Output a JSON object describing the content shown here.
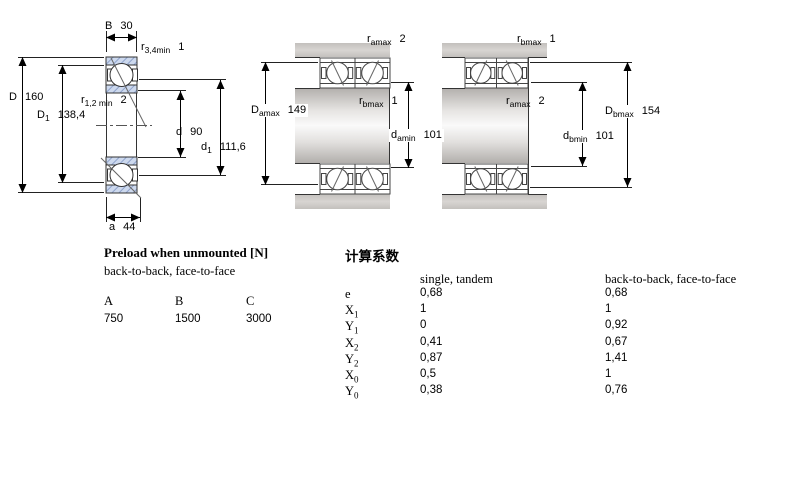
{
  "colors": {
    "ring_hatch_fill": "#cdd9ee",
    "ring_hatch_line": "#8fa3cc",
    "metal_gray": "#c9c6c3"
  },
  "drawing_left": {
    "labels": {
      "B": {
        "sym": "B",
        "val": "30"
      },
      "r34": {
        "sym": "r",
        "sub": "3,4min",
        "val": "1"
      },
      "D": {
        "sym": "D",
        "val": "160"
      },
      "D1": {
        "sym": "D",
        "sub": "1",
        "val": "138,4"
      },
      "r12": {
        "sym": "r",
        "sub": "1,2 min",
        "val": "2"
      },
      "d": {
        "sym": "d",
        "val": "90"
      },
      "d1": {
        "sym": "d",
        "sub": "1",
        "val": "111,6"
      },
      "a": {
        "sym": "a",
        "val": "44"
      }
    }
  },
  "drawing_middle": {
    "labels": {
      "ramax_top": {
        "sym": "r",
        "sub": "amax",
        "val": "2"
      },
      "Damax": {
        "sym": "D",
        "sub": "amax",
        "val": "149"
      },
      "rbmax": {
        "sym": "r",
        "sub": "bmax",
        "val": "1"
      },
      "damin": {
        "sym": "d",
        "sub": "amin",
        "val": "101"
      }
    }
  },
  "drawing_right": {
    "labels": {
      "rbmax_top": {
        "sym": "r",
        "sub": "bmax",
        "val": "1"
      },
      "ramax": {
        "sym": "r",
        "sub": "amax",
        "val": "2"
      },
      "Dbmax": {
        "sym": "D",
        "sub": "bmax",
        "val": "154"
      },
      "dbmin": {
        "sym": "d",
        "sub": "bmin",
        "val": "101"
      }
    }
  },
  "preload_table": {
    "title": "Preload when unmounted [N]",
    "subtitle": "back-to-back, face-to-face",
    "columns": [
      {
        "header": "A",
        "value": "750"
      },
      {
        "header": "B",
        "value": "1500"
      },
      {
        "header": "C",
        "value": "3000"
      }
    ]
  },
  "factors_table": {
    "title": "计算系数",
    "col1_header": "single, tandem",
    "col2_header": "back-to-back, face-to-face",
    "rows": [
      {
        "sym": "e",
        "sub": "",
        "v1": "0,68",
        "v2": "0,68"
      },
      {
        "sym": "X",
        "sub": "1",
        "v1": "1",
        "v2": "1"
      },
      {
        "sym": "Y",
        "sub": "1",
        "v1": "0",
        "v2": "0,92"
      },
      {
        "sym": "X",
        "sub": "2",
        "v1": "0,41",
        "v2": "0,67"
      },
      {
        "sym": "Y",
        "sub": "2",
        "v1": "0,87",
        "v2": "1,41"
      },
      {
        "sym": "X",
        "sub": "0",
        "v1": "0,5",
        "v2": "1"
      },
      {
        "sym": "Y",
        "sub": "0",
        "v1": "0,38",
        "v2": "0,76"
      }
    ]
  }
}
